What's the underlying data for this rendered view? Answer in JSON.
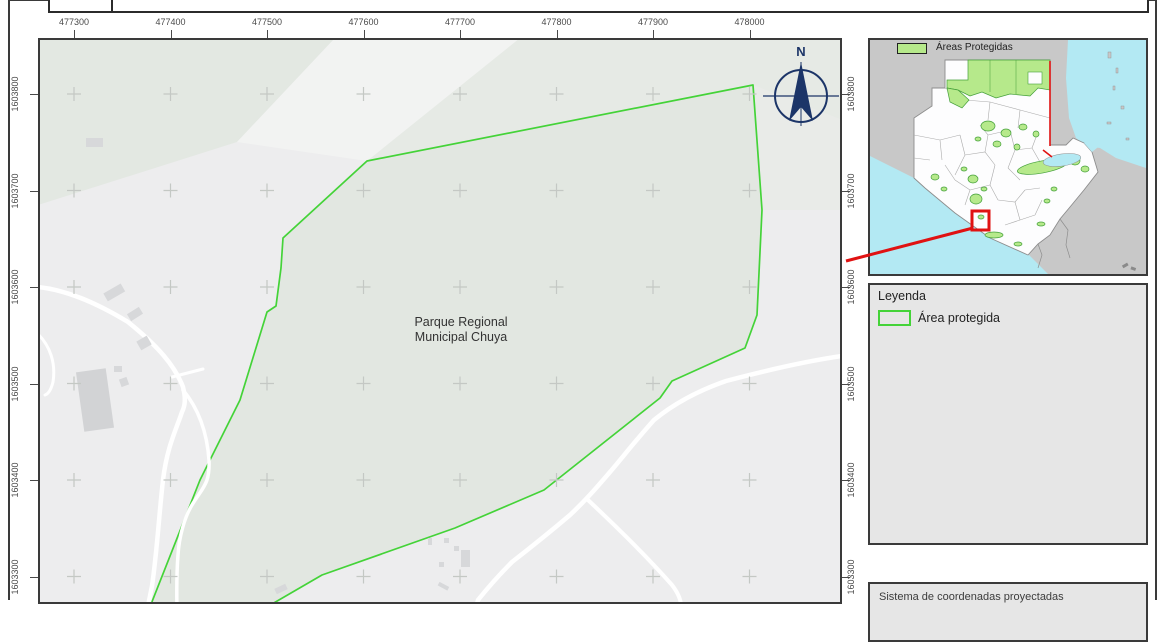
{
  "main_map": {
    "x_axis_labels": [
      "477300",
      "477400",
      "477500",
      "477600",
      "477700",
      "477800",
      "477900",
      "478000"
    ],
    "y_axis_labels": [
      "1603800",
      "1603700",
      "1603600",
      "1603500",
      "1603400",
      "1603300"
    ],
    "place_label_line1": "Parque Regional",
    "place_label_line2": "Municipal Chuya",
    "north_label": "N"
  },
  "inset_map": {
    "legend_label": "Áreas Protegidas"
  },
  "legend_panel": {
    "title": "Leyenda",
    "item_label": "Área protegida"
  },
  "footer_panel": {
    "text": "Sistema de coordenadas proyectadas"
  },
  "colors": {
    "protected_outline_green": "#44d338",
    "inset_protected_fill": "#b6e98b",
    "water_cyan": "#b3e9f3",
    "neighbor_land_gray": "#c8c8c8",
    "locator_red": "#e01212",
    "north_arrow_navy": "#1c3568",
    "panel_gray": "#e6e6e6"
  }
}
